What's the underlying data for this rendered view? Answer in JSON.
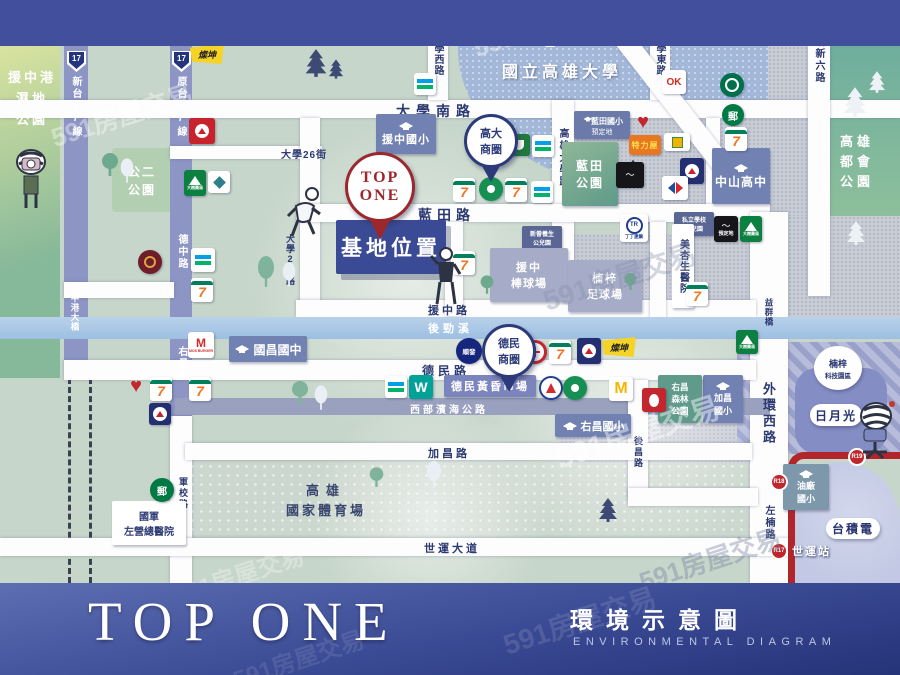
{
  "watermark": "591房屋交易",
  "footer": {
    "brand": "TOP ONE",
    "title_zh": "環境示意圖",
    "title_en": "ENVIRONMENTAL DIAGRAM"
  },
  "site": {
    "pin": [
      "TOP",
      "ONE"
    ],
    "label": "基地位置"
  },
  "roads": {
    "shield": "17",
    "xintai17": "新台17線",
    "yuantai17": "原台17線",
    "daxue_s": "大學南路",
    "daxue_w": "大學西路",
    "daxue_e": "大學東路",
    "qiaoxin6": "橋新六路",
    "daxue26": "大學26街",
    "daxue29": "大學29路",
    "gd_univ": "高雄大學路",
    "lantian": "藍田路",
    "yuanzhong": "援中路",
    "dezhong": "德中路",
    "youchang_st": "右昌街",
    "junxiao": "軍校路",
    "demin": "德民路",
    "coast": "西部濱海公路",
    "jiachang": "加昌路",
    "shiyun": "世運大道",
    "houchang": "後昌路",
    "waihuan": "外環西路",
    "zuonan": "左楠路"
  },
  "water": {
    "river": "後勁溪",
    "bridge_yzg": "援中港大橋",
    "bridge_yq": "益群橋"
  },
  "mrt": {
    "r19": "R19",
    "r18": "R18",
    "r17": "R17",
    "station": "世運站"
  },
  "schools": {
    "nuk": "國立高雄大學",
    "yuanzhong_es": "援中國小",
    "lantian_es": [
      "藍田國小",
      "預定地"
    ],
    "zhongshan_hs": "中山高中",
    "guochang_jhs": "國昌國中",
    "youchang_es": "右昌國小",
    "jiachang_es": [
      "加昌",
      "國小"
    ],
    "oil_es": [
      "油廠",
      "國小"
    ],
    "kindergarten": [
      "私立學校",
      "幼兒園"
    ],
    "care_park": [
      "新眷養生",
      "公兒園"
    ]
  },
  "biz": {
    "gaoda": [
      "高大",
      "商圈"
    ],
    "demin": [
      "德民",
      "商圈"
    ]
  },
  "parks": {
    "wetland": [
      "援中港",
      "濕地",
      "公園"
    ],
    "gong2": [
      "公二",
      "公園"
    ],
    "lantian": [
      "藍田",
      "公園"
    ],
    "metro": [
      "高雄",
      "都會",
      "公園"
    ],
    "forest": [
      "右昌",
      "森林",
      "公園"
    ]
  },
  "places": {
    "baseball": [
      "援中",
      "棒球場"
    ],
    "soccer": [
      "楠梓",
      "足球場"
    ],
    "hospital": "美杏生醫院",
    "market": "德民黃昏市場",
    "stadium": [
      "高雄",
      "國家體育場"
    ],
    "military": [
      "國軍",
      "左營總醫院"
    ],
    "ase": "日月光",
    "tsmc": "台積電",
    "tech_park": [
      "楠梓",
      "科技園區"
    ]
  },
  "brands": {
    "seven": "7",
    "tsannkun": "燦坤",
    "teli": "特力屋",
    "tr": "TR",
    "tr_sub": "丁丁連鎖",
    "dashu": "大樹藥局",
    "sunfar": "順發",
    "ok": "OK",
    "watsons": "W",
    "mos": "M",
    "mos_sub": "MOS BURGER",
    "mcd": "M",
    "post": "郵",
    "reserved": "預定地"
  }
}
